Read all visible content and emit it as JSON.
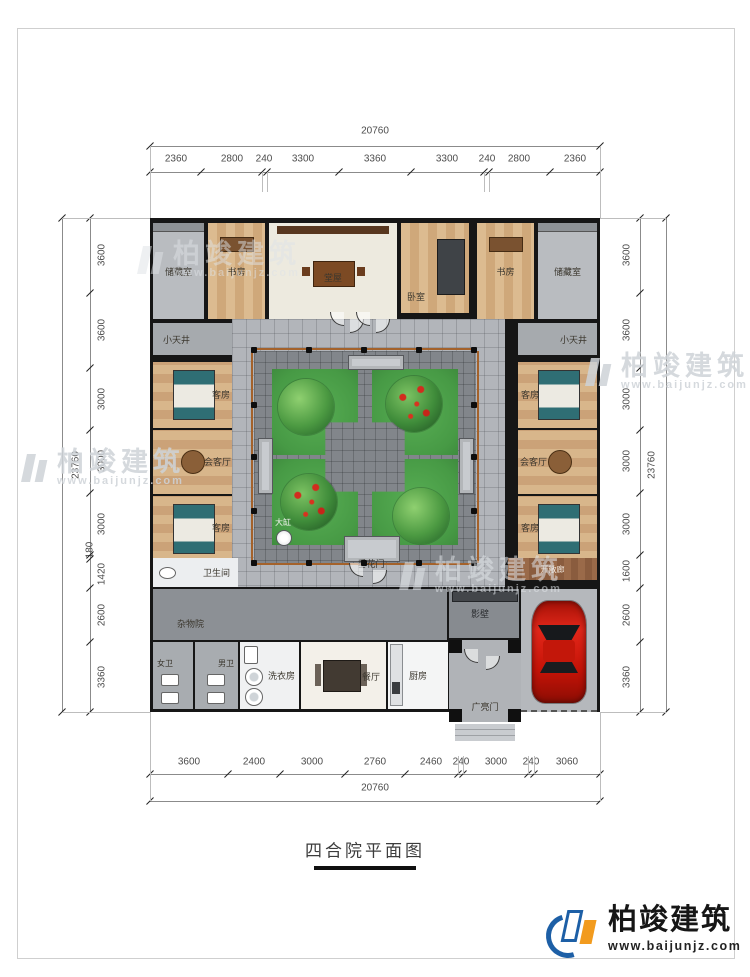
{
  "page": {
    "title_text": "四合院平面图"
  },
  "brand": {
    "name": "柏竣建筑",
    "site": "www.baijunjz.com"
  },
  "watermark": {
    "name": "柏竣建筑",
    "site": "www.baijunjz.com"
  },
  "plan": {
    "rooms": {
      "storage": "储藏室",
      "study": "书房",
      "hall": "堂屋",
      "bedroom": "卧室",
      "light_well": "小天井",
      "guest_room": "客房",
      "reception": "会客厅",
      "bathroom": "卫生间",
      "chore_yard": "杂物院",
      "womens_wc": "女卫",
      "mens_wc": "男卫",
      "laundry": "洗衣房",
      "dining": "餐厅",
      "kitchen": "厨房",
      "festoon_gate": "垂花门",
      "grand_gate": "广亮门",
      "screen_wall": "影壁",
      "big_vat": "大缸",
      "open_corridor": "开敞廊"
    }
  },
  "dimensions": {
    "top": {
      "total": "20760",
      "segments": [
        "2360",
        "2800",
        "240",
        "3300",
        "3360",
        "3300",
        "240",
        "2800",
        "2360"
      ]
    },
    "bottom": {
      "total": "20760",
      "segments": [
        "3600",
        "2400",
        "3000",
        "2760",
        "2460",
        "240",
        "3000",
        "240",
        "3060"
      ]
    },
    "left": {
      "total": "23760",
      "segments": [
        "3600",
        "3600",
        "3000",
        "3000",
        "3000",
        "180",
        "1420",
        "2600",
        "3360"
      ]
    },
    "right": {
      "total": "23760",
      "segments": [
        "3600",
        "3600",
        "3000",
        "3000",
        "3000",
        "1600",
        "2600",
        "3360"
      ]
    }
  },
  "colors": {
    "wall_black": "#161616",
    "paving_gray": "#b2b5ba",
    "court_gray": "#82868b",
    "lawn_green": "#4fa24f",
    "car_red": "#c8180c",
    "brand_blue": "#1d5fa6",
    "brand_orange": "#f29b1e"
  }
}
